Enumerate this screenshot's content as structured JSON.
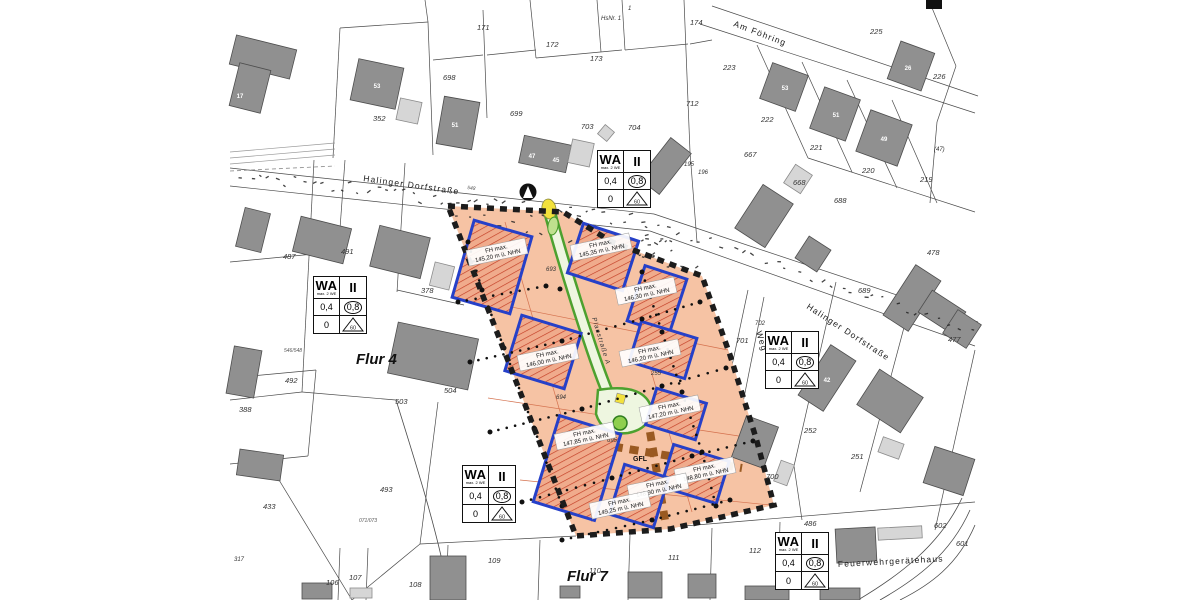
{
  "map_type": "Bebauungsplan (German development / zoning plan)",
  "colors": {
    "site_fill": "#f6c3a4",
    "site_inner_line": "#d4714e",
    "window_stroke": "#2640c8",
    "hatch_red": "#c23b22",
    "boundary_black": "#1c1c1c",
    "green_path": "#4da12f",
    "green_fill": "#eef6e0",
    "gfl_brown": "#9a5a22",
    "building_dark": "#909090",
    "building_light": "#d6d6d6",
    "yellow": "#f2e13c"
  },
  "wa_box": {
    "zone": "WA",
    "zone_sub": "max. 2 WE",
    "storeys": "II",
    "grz": "0,4",
    "gfz": "0,8",
    "open_space": "0",
    "roof_angle": "60"
  },
  "wa_box_positions": [
    {
      "x": 597,
      "y": 150
    },
    {
      "x": 313,
      "y": 276
    },
    {
      "x": 765,
      "y": 331
    },
    {
      "x": 462,
      "y": 465
    },
    {
      "x": 775,
      "y": 532
    }
  ],
  "flur_labels": [
    {
      "text": "Flur 4",
      "x": 356,
      "y": 364
    },
    {
      "text": "Flur 7",
      "x": 567,
      "y": 581
    }
  ],
  "street_labels": [
    {
      "text": "Halinger Dorfstraße",
      "x": 363,
      "y": 181,
      "rot": 8
    },
    {
      "text": "Halinger Dorfstraße",
      "x": 806,
      "y": 308,
      "rot": 33
    },
    {
      "text": "Am Föhring",
      "x": 733,
      "y": 26,
      "rot": 21
    },
    {
      "text": "Weg",
      "x": 756,
      "y": 332,
      "rot": 73
    },
    {
      "text": "Feuerwehrgerätehaus",
      "x": 838,
      "y": 567,
      "rot": -3
    }
  ],
  "path_label": {
    "text": "Planstraße A",
    "x": 592,
    "y": 318,
    "rot": 73
  },
  "gfl_label": {
    "text": "GFL",
    "x": 640,
    "y": 461
  },
  "fh_title": "FH max.",
  "fh_labels": [
    {
      "value": "145,20 m ü. NHN",
      "x": 497,
      "y": 252
    },
    {
      "value": "145,35 m ü. NHN",
      "x": 601,
      "y": 247
    },
    {
      "value": "146,30 m ü. NHN",
      "x": 646,
      "y": 291
    },
    {
      "value": "146,00 m ü. NHN",
      "x": 548,
      "y": 357
    },
    {
      "value": "146,20 m ü. NHN",
      "x": 650,
      "y": 353
    },
    {
      "value": "147,20 m ü. NHN",
      "x": 670,
      "y": 409
    },
    {
      "value": "147,85 m ü. NHN",
      "x": 585,
      "y": 436
    },
    {
      "value": "148,80 m ü. NHN",
      "x": 705,
      "y": 471
    },
    {
      "value": "148,90 m ü. NHN",
      "x": 658,
      "y": 487
    },
    {
      "value": "149,25 m ü. NHN",
      "x": 620,
      "y": 505
    }
  ],
  "parcel_labels": [
    {
      "text": "171",
      "x": 477,
      "y": 30
    },
    {
      "text": "172",
      "x": 546,
      "y": 47
    },
    {
      "text": "173",
      "x": 590,
      "y": 61
    },
    {
      "text": "174",
      "x": 690,
      "y": 25
    },
    {
      "text": "HsNr. 1",
      "x": 601,
      "y": 20,
      "size": 6
    },
    {
      "text": "1",
      "x": 628,
      "y": 10,
      "size": 6
    },
    {
      "text": "223",
      "x": 723,
      "y": 70
    },
    {
      "text": "225",
      "x": 870,
      "y": 34
    },
    {
      "text": "226",
      "x": 933,
      "y": 79
    },
    {
      "text": "222",
      "x": 761,
      "y": 122
    },
    {
      "text": "221",
      "x": 810,
      "y": 150
    },
    {
      "text": "220",
      "x": 862,
      "y": 173
    },
    {
      "text": "219",
      "x": 920,
      "y": 182
    },
    {
      "text": "(47)",
      "x": 934,
      "y": 151,
      "size": 6
    },
    {
      "text": "195",
      "x": 684,
      "y": 166,
      "size": 6
    },
    {
      "text": "196",
      "x": 698,
      "y": 174,
      "size": 6
    },
    {
      "text": "667",
      "x": 744,
      "y": 157
    },
    {
      "text": "668",
      "x": 793,
      "y": 185
    },
    {
      "text": "688",
      "x": 834,
      "y": 203
    },
    {
      "text": "689",
      "x": 858,
      "y": 293
    },
    {
      "text": "712",
      "x": 686,
      "y": 106
    },
    {
      "text": "698",
      "x": 443,
      "y": 80
    },
    {
      "text": "699",
      "x": 510,
      "y": 116
    },
    {
      "text": "703",
      "x": 581,
      "y": 129
    },
    {
      "text": "704",
      "x": 628,
      "y": 130
    },
    {
      "text": "352",
      "x": 373,
      "y": 121
    },
    {
      "text": "487",
      "x": 283,
      "y": 259
    },
    {
      "text": "491",
      "x": 341,
      "y": 254
    },
    {
      "text": "378",
      "x": 421,
      "y": 293
    },
    {
      "text": "492",
      "x": 285,
      "y": 383
    },
    {
      "text": "388",
      "x": 239,
      "y": 412
    },
    {
      "text": "503",
      "x": 395,
      "y": 404
    },
    {
      "text": "504",
      "x": 444,
      "y": 393
    },
    {
      "text": "493",
      "x": 380,
      "y": 492
    },
    {
      "text": "433",
      "x": 263,
      "y": 509
    },
    {
      "text": "317",
      "x": 234,
      "y": 561,
      "size": 6
    },
    {
      "text": "106",
      "x": 326,
      "y": 585
    },
    {
      "text": "107",
      "x": 349,
      "y": 580
    },
    {
      "text": "108",
      "x": 409,
      "y": 587
    },
    {
      "text": "109",
      "x": 488,
      "y": 563
    },
    {
      "text": "110",
      "x": 589,
      "y": 573
    },
    {
      "text": "111",
      "x": 668,
      "y": 560
    },
    {
      "text": "112",
      "x": 749,
      "y": 553
    },
    {
      "text": "693",
      "x": 546,
      "y": 271,
      "size": 6
    },
    {
      "text": "694",
      "x": 556,
      "y": 399,
      "size": 6
    },
    {
      "text": "695",
      "x": 607,
      "y": 442,
      "size": 6
    },
    {
      "text": "255",
      "x": 651,
      "y": 375,
      "size": 6
    },
    {
      "text": "700",
      "x": 766,
      "y": 479
    },
    {
      "text": "701",
      "x": 736,
      "y": 343
    },
    {
      "text": "702",
      "x": 755,
      "y": 325,
      "size": 6
    },
    {
      "text": "252",
      "x": 804,
      "y": 433
    },
    {
      "text": "251",
      "x": 851,
      "y": 459
    },
    {
      "text": "486",
      "x": 804,
      "y": 526
    },
    {
      "text": "602",
      "x": 934,
      "y": 528
    },
    {
      "text": "601",
      "x": 956,
      "y": 546
    },
    {
      "text": "477",
      "x": 948,
      "y": 342
    },
    {
      "text": "478",
      "x": 927,
      "y": 255
    }
  ],
  "house_numbers": [
    {
      "text": "17",
      "x": 240,
      "y": 98
    },
    {
      "text": "53",
      "x": 377,
      "y": 88
    },
    {
      "text": "51",
      "x": 455,
      "y": 127
    },
    {
      "text": "47",
      "x": 532,
      "y": 158
    },
    {
      "text": "45",
      "x": 556,
      "y": 162
    },
    {
      "text": "53",
      "x": 785,
      "y": 90
    },
    {
      "text": "51",
      "x": 836,
      "y": 117
    },
    {
      "text": "49",
      "x": 884,
      "y": 141
    },
    {
      "text": "26",
      "x": 908,
      "y": 70
    },
    {
      "text": "42",
      "x": 827,
      "y": 382
    }
  ],
  "small_labels": [
    {
      "text": "548",
      "x": 467,
      "y": 189,
      "rot": 8
    },
    {
      "text": "546/548",
      "x": 284,
      "y": 352
    },
    {
      "text": "071/073",
      "x": 359,
      "y": 522
    }
  ]
}
